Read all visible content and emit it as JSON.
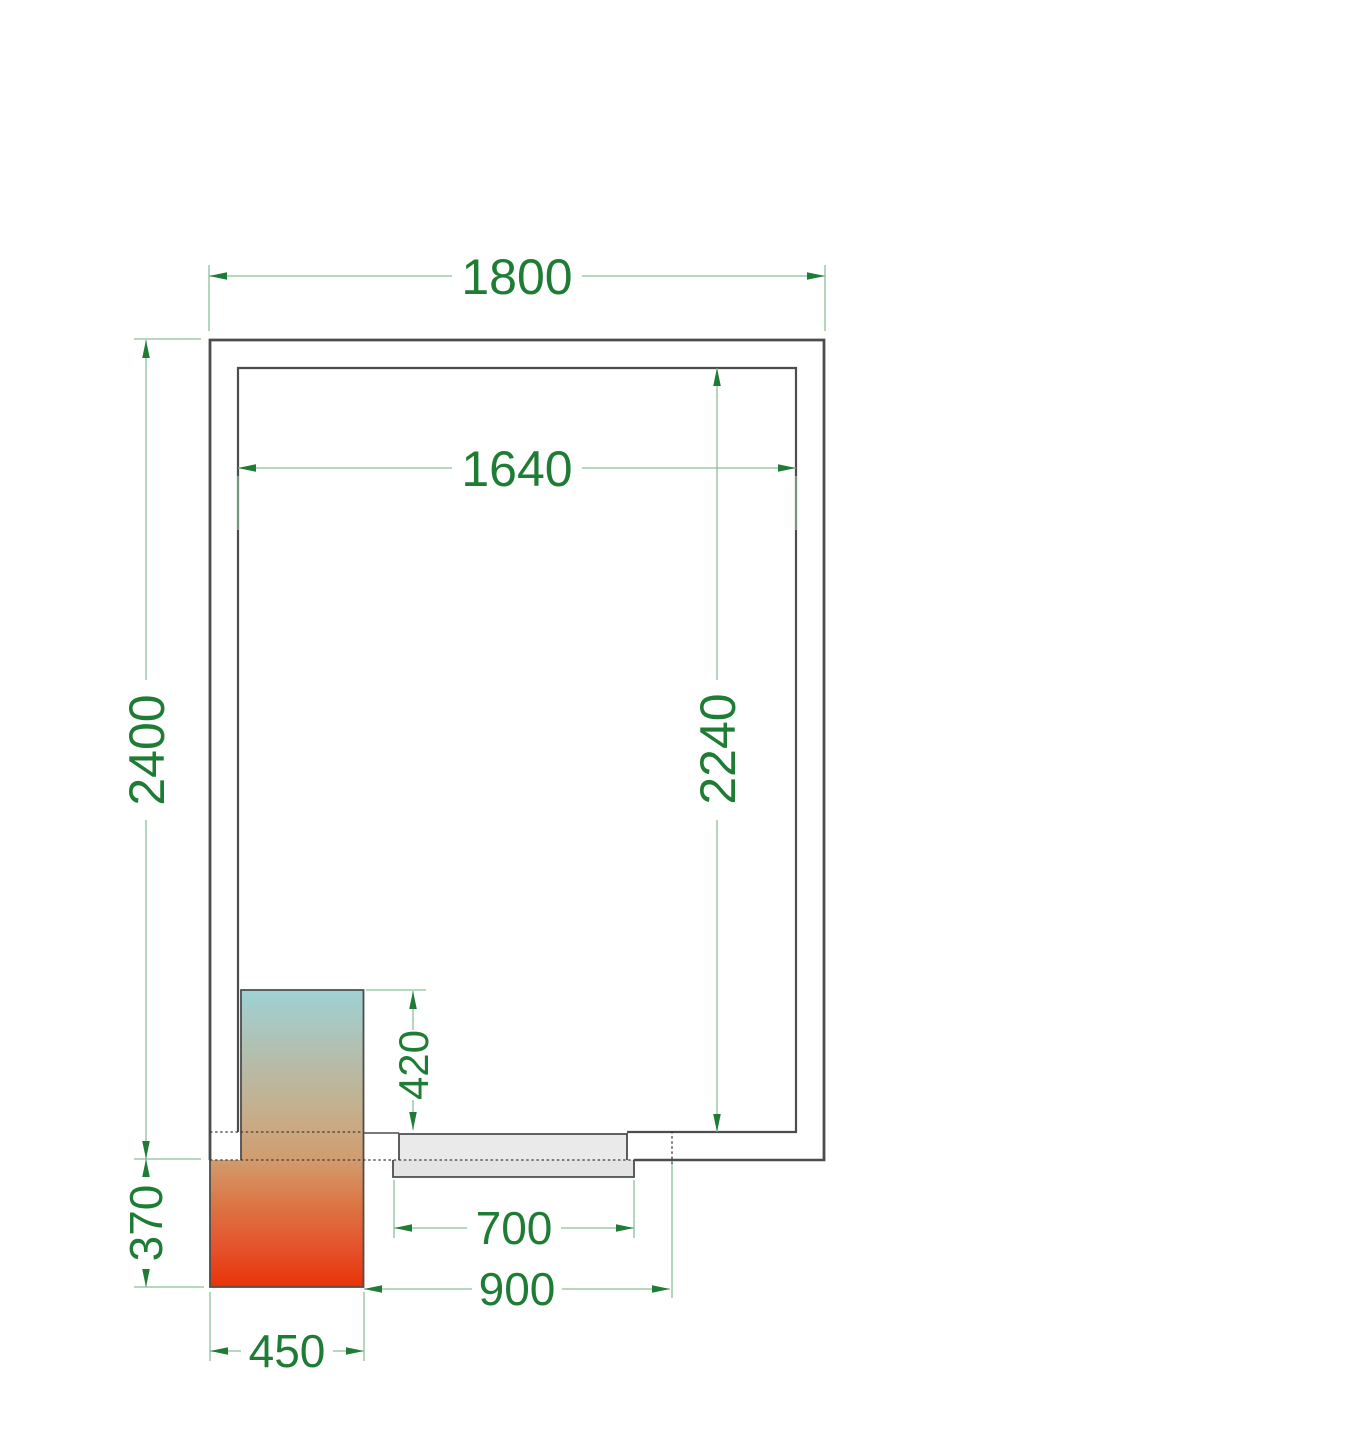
{
  "labels": {
    "outer_width": "1800",
    "inner_width": "1640",
    "outer_depth": "2400",
    "inner_depth": "2240",
    "unit_depth_inside": "420",
    "unit_overhang": "370",
    "door_leaf_width": "700",
    "door_opening_width": "900",
    "unit_width": "450"
  },
  "colors": {
    "background": "#ffffff",
    "wall_line": "#4d4d4d",
    "hidden_edge": "#3c3c3c",
    "dim_line": "#8abf9b",
    "dim_accent": "#1e7c34",
    "door_leaf_fill": "#eaeaea",
    "door_sill_fill": "#e4e4e4",
    "unit_grad_cold": "#9ed1d5",
    "unit_grad_cool": "#c9ab85",
    "unit_grad_warm": "#d19c6e",
    "unit_grad_hot": "#dc7544",
    "unit_grad_flame": "#e5512a",
    "unit_grad_red": "#ea3208"
  }
}
